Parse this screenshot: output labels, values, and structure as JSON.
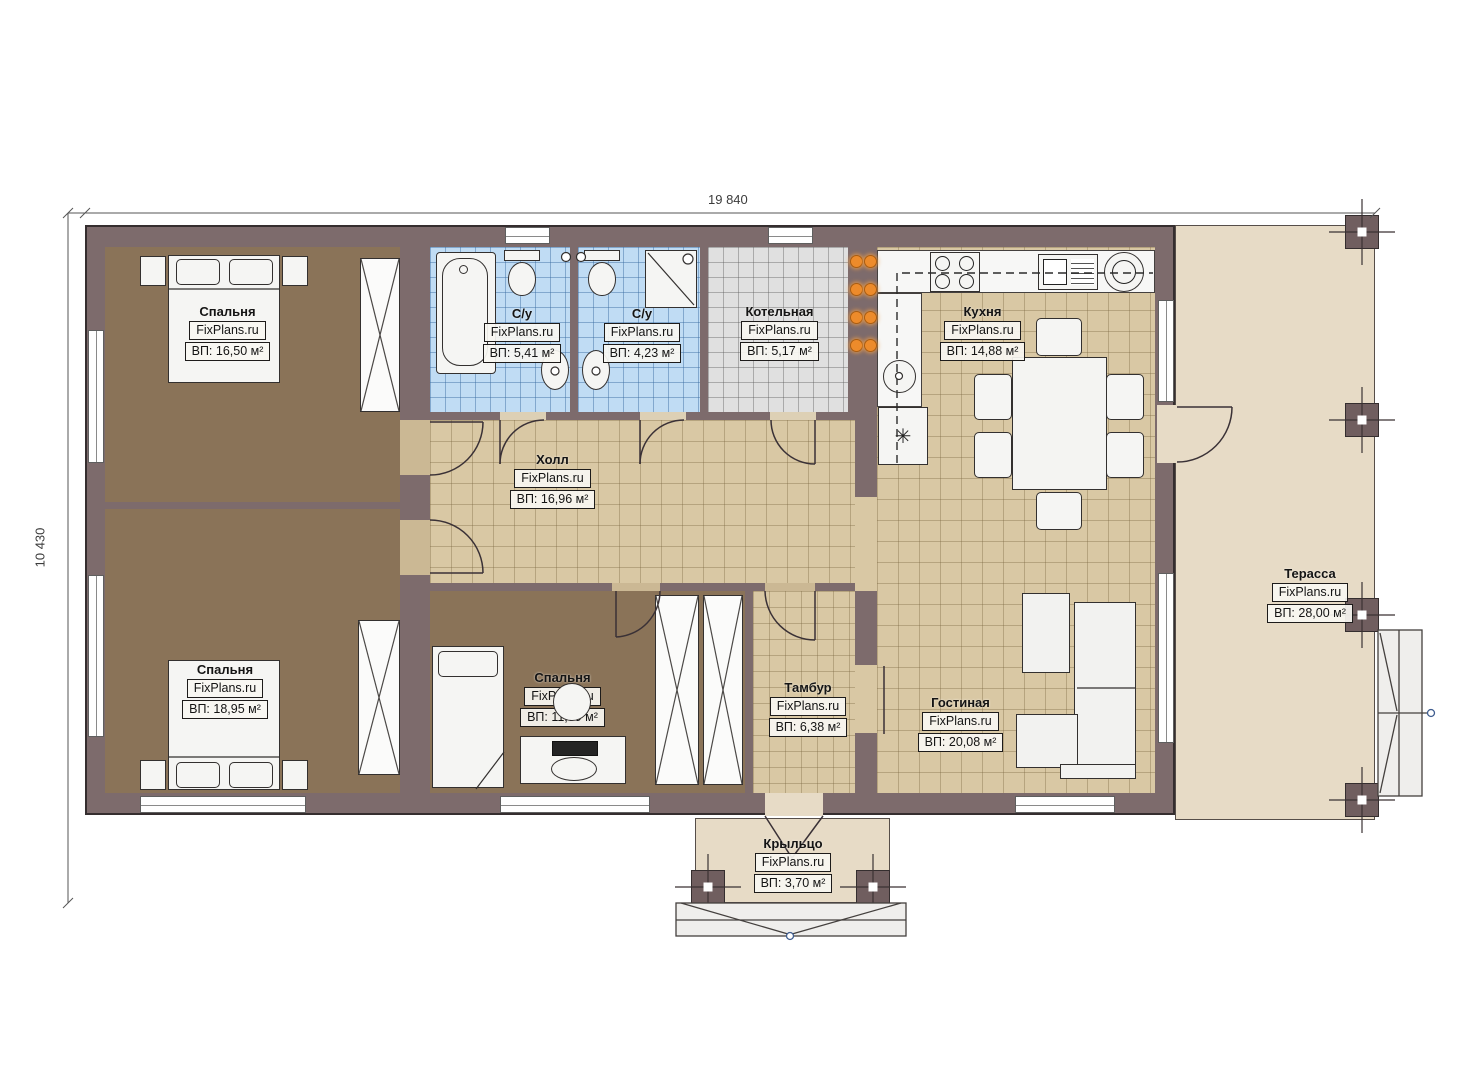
{
  "plan": {
    "dimensions": {
      "width": "19 840",
      "height": "10 430"
    },
    "rooms": [
      {
        "name": "Спальня",
        "watermark": "FixPlans.ru",
        "area": "ВП: 16,50 м²"
      },
      {
        "name": "С/у",
        "watermark": "FixPlans.ru",
        "area": "ВП: 5,41 м²"
      },
      {
        "name": "С/у",
        "watermark": "FixPlans.ru",
        "area": "ВП: 4,23 м²"
      },
      {
        "name": "Котельная",
        "watermark": "FixPlans.ru",
        "area": "ВП: 5,17 м²"
      },
      {
        "name": "Кухня",
        "watermark": "FixPlans.ru",
        "area": "ВП: 14,88 м²"
      },
      {
        "name": "Холл",
        "watermark": "FixPlans.ru",
        "area": "ВП: 16,96 м²"
      },
      {
        "name": "Спальня",
        "watermark": "FixPlans.ru",
        "area": "ВП: 18,95 м²"
      },
      {
        "name": "Спальня",
        "watermark": "FixPlans.ru",
        "area": "ВП: 11,89 м²"
      },
      {
        "name": "Тамбур",
        "watermark": "FixPlans.ru",
        "area": "ВП: 6,38 м²"
      },
      {
        "name": "Гостиная",
        "watermark": "FixPlans.ru",
        "area": "ВП: 20,08 м²"
      },
      {
        "name": "Терасса",
        "watermark": "FixPlans.ru",
        "area": "ВП: 28,00 м²"
      },
      {
        "name": "Крыльцо",
        "watermark": "FixPlans.ru",
        "area": "ВП: 3,70 м²"
      }
    ],
    "symbols": {
      "fridge": "✳"
    },
    "colors": {
      "wall": "#7d6b6c",
      "bedroom_floor": "#8a7358",
      "tile_floor": "#d9c8a4",
      "bathroom_floor": "#c0dcf4",
      "boiler_floor": "#e0e0e0",
      "terrace_floor": "#e7dbc6",
      "equipment_orange": "#ed8b2b",
      "marker_blue": "#3f5d8f"
    }
  }
}
